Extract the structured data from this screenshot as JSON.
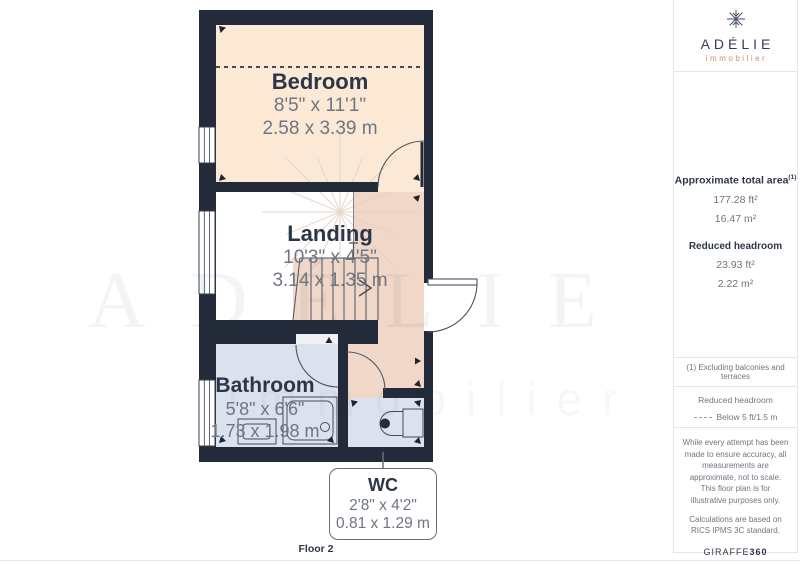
{
  "theme": {
    "wall_color": "#232b3a",
    "bedroom_fill": "#fbe9d6",
    "reduced_headroom_fill": "#f0d7c8",
    "wet_room_fill": "#dce1ee",
    "label_color": "#2b3648",
    "dimension_text_color": "#6e7682",
    "brand_navy": "#343f55",
    "brand_salmon": "#cf8a74"
  },
  "floor_plan": {
    "floor_label": "Floor 2",
    "rooms": [
      {
        "name": "Bedroom",
        "imperial": "8'5\" x 11'1\"",
        "metric": "2.58 x 3.39 m"
      },
      {
        "name": "Landing",
        "imperial": "10'3\" x 4'5\"",
        "metric": "3.14 x 1.35 m"
      },
      {
        "name": "Bathroom",
        "imperial": "5'8\" x 6'6\"",
        "metric": "1.73 x 1.98 m"
      },
      {
        "name": "WC",
        "imperial": "2'8\" x 4'2\"",
        "metric": "0.81 x 1.29 m"
      }
    ]
  },
  "watermark": {
    "brand": "ADÉLIE",
    "tagline": "immobilier"
  },
  "sidebar": {
    "logo": {
      "brand": "ADÉLIE",
      "tagline": "immobilier"
    },
    "areas": {
      "total_label": "Approximate total area",
      "total_footnote_marker": "(1)",
      "total_imperial": "177.28 ft²",
      "total_metric": "16.47 m²",
      "reduced_label": "Reduced headroom",
      "reduced_imperial": "23.93 ft²",
      "reduced_metric": "2.22 m²"
    },
    "footnote": "(1) Excluding balconies and terraces",
    "legend": {
      "title": "Reduced headroom",
      "item": "Below 5 ft/1.5 m"
    },
    "disclaimer": {
      "p1": "While every attempt has been made to ensure accuracy, all measurements are approximate, not to scale. This floor plan is for illustrative purposes only.",
      "p2": "Calculations are based on RICS IPMS 3C standard.",
      "brand": "GIRAFFE",
      "brand_suffix": "360"
    }
  }
}
